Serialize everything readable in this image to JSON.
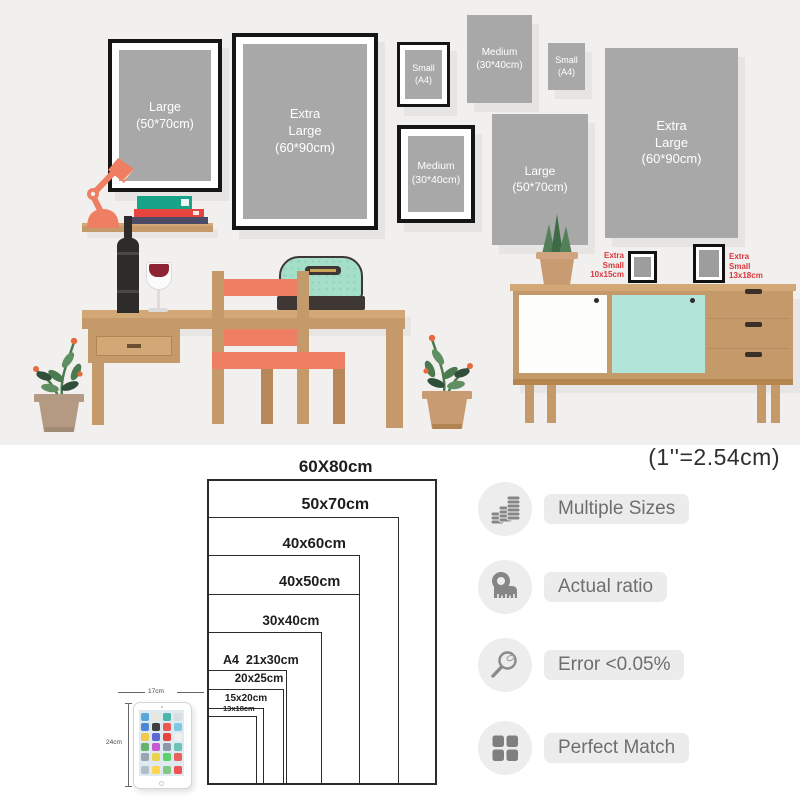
{
  "scene": {
    "wall_frames": [
      {
        "label": "Large\n(50*70cm)"
      },
      {
        "label": "Extra\nLarge\n(60*90cm)"
      },
      {
        "label": "Small\n(A4)"
      },
      {
        "label": "Medium\n(30*40cm)"
      },
      {
        "label": "Small\n(A4)"
      },
      {
        "label": "Medium\n(30*40cm)"
      },
      {
        "label": "Large\n(50*70cm)"
      },
      {
        "label": "Extra\nLarge\n(60*90cm)"
      }
    ],
    "tabletop_frame_labels": {
      "left": "Extra\nSmall\n10x15cm",
      "right": "Extra\nSmall\n13x18cm"
    }
  },
  "size_chart": {
    "unit_note": "(1''=2.54cm)",
    "sizes": [
      {
        "label": "60X80cm",
        "w_cm": 60,
        "h_cm": 80
      },
      {
        "label": "50x70cm",
        "w_cm": 50,
        "h_cm": 70
      },
      {
        "label": "40x60cm",
        "w_cm": 40,
        "h_cm": 60
      },
      {
        "label": "40x50cm",
        "w_cm": 40,
        "h_cm": 50
      },
      {
        "label": "30x40cm",
        "w_cm": 30,
        "h_cm": 40
      },
      {
        "label": "A4  21x30cm",
        "w_cm": 21,
        "h_cm": 30
      },
      {
        "label": "20x25cm",
        "w_cm": 20,
        "h_cm": 25
      },
      {
        "label": "15x20cm",
        "w_cm": 15,
        "h_cm": 20
      },
      {
        "label": "13x18cm",
        "w_cm": 13,
        "h_cm": 18
      }
    ],
    "tablet_reference": {
      "width_label": "17cm",
      "height_label": "24cm"
    }
  },
  "features": [
    {
      "icon": "coins-icon",
      "label": "Multiple Sizes"
    },
    {
      "icon": "tape-measure-icon",
      "label": "Actual ratio"
    },
    {
      "icon": "magnifier-icon",
      "label": "Error <0.05%"
    },
    {
      "icon": "grid-icon",
      "label": "Perfect Match"
    }
  ],
  "colors": {
    "poster_gray": "#a8a8a8",
    "frame_black": "#161616",
    "wood": "#c59a6a",
    "coral": "#ee7f63",
    "mint": "#a5dfc9",
    "mint_door": "#b2e4d9",
    "red_label": "#d9363c",
    "scene_background": "#f1f0ee"
  }
}
